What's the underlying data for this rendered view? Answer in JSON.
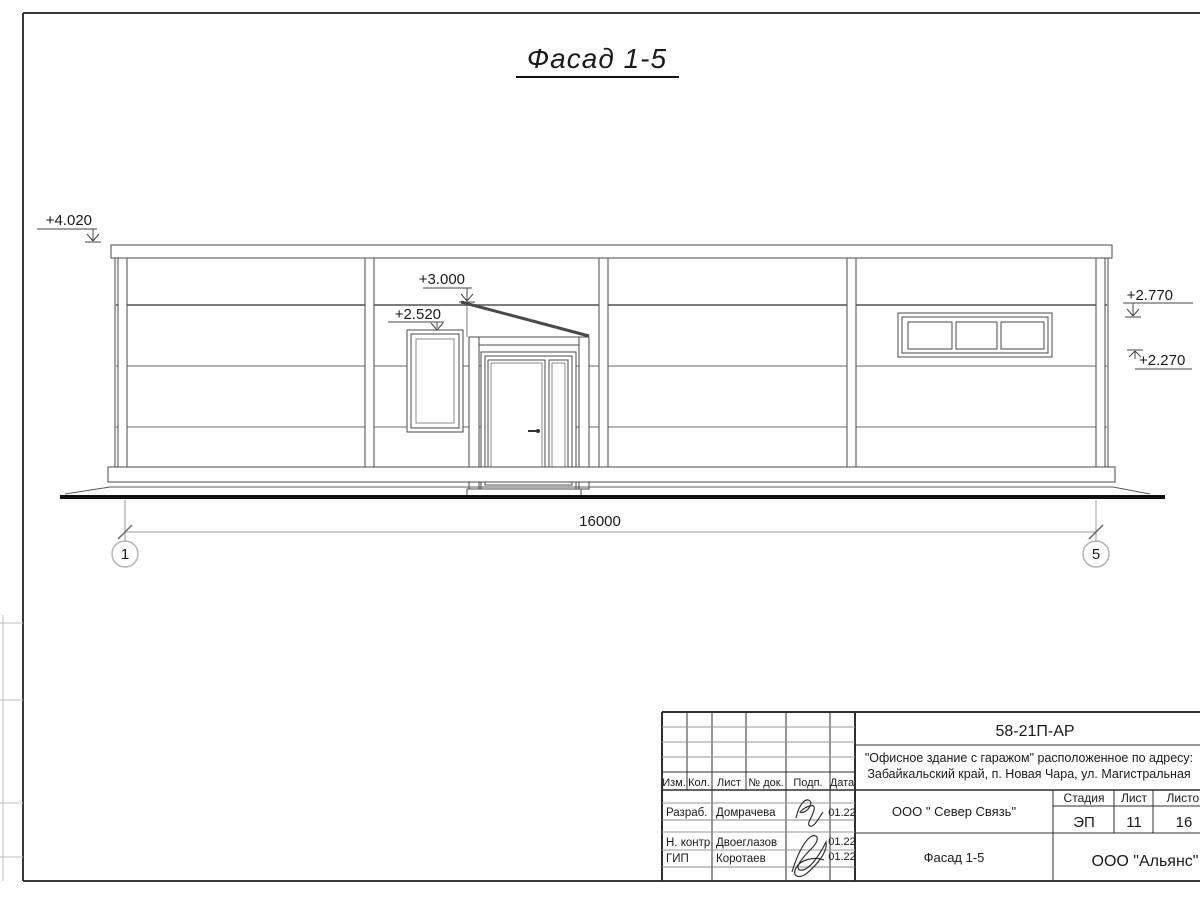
{
  "drawing": {
    "title": "Фасад 1-5",
    "elevations": {
      "parapet": "+4.020",
      "canopy": "+3.000",
      "left_window": "+2.520",
      "right_upper": "+2.770",
      "right_lower": "+2.270"
    },
    "dimension_total": "16000",
    "axes": {
      "left": "1",
      "right": "5"
    }
  },
  "title_block": {
    "doc_code": "58-21П-АР",
    "project_address_line1": "\"Офисное здание с гаражом\" расположенное по адресу:",
    "project_address_line2": "Забайкальский край, п. Новая Чара, ул. Магистральная",
    "columns": {
      "izm": "Изм.",
      "kol": "Кол.",
      "list": "Лист",
      "doc_no": "№ док.",
      "sign": "Подп.",
      "date": "Дата"
    },
    "roles": {
      "developer_label": "Разраб.",
      "developer_name": "Домрачева",
      "developer_date": "01.22",
      "checker_label": "Н. контр.",
      "checker_name": "Двоеглазов",
      "checker_date": "01.22",
      "gip_label": "ГИП",
      "gip_name": "Коротаев",
      "gip_date": "01.22"
    },
    "client": "ООО \" Север Связь\"",
    "sheet_name": "Фасад 1-5",
    "contractor": "ООО \"Альянс\"",
    "stage_label": "Стадия",
    "list_label": "Лист",
    "listov_label": "Листов",
    "stage_value": "ЭП",
    "list_value": "11",
    "listov_value": "16"
  },
  "colors": {
    "line": "#3a3a3a",
    "light_line": "#999999",
    "ground": "#111111"
  }
}
